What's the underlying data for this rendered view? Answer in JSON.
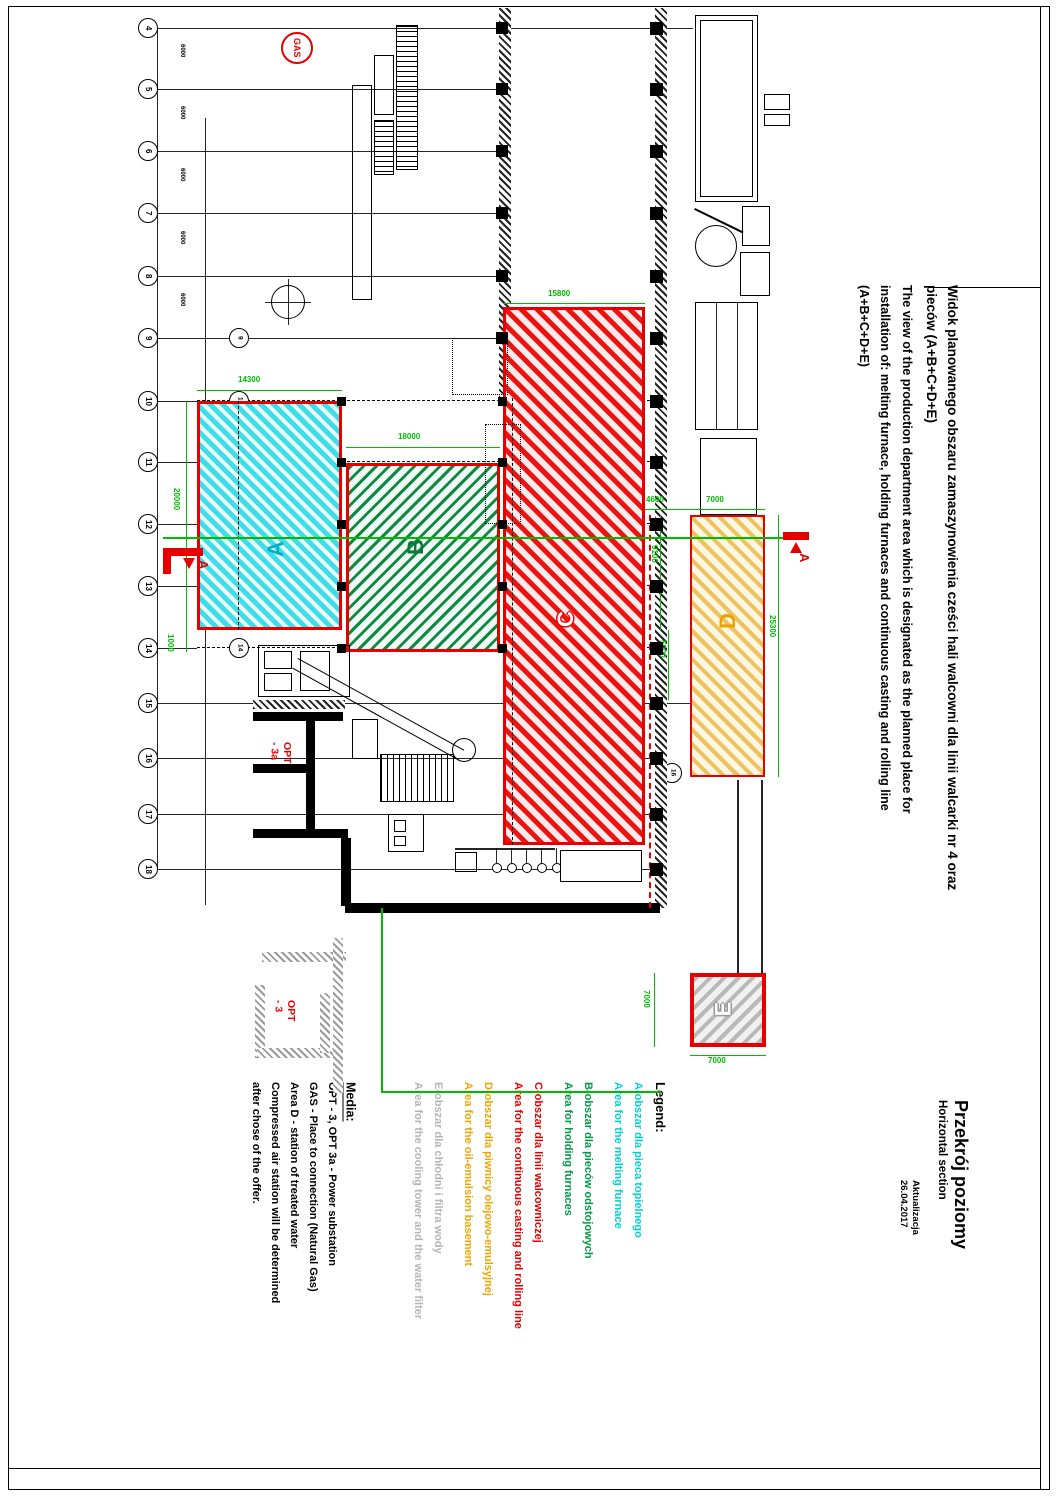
{
  "page": {
    "title_pl_1": "Widok planowanego obszaru zamaszynowienia cześci hali walcowni dla linii walcarki nr 4 oraz",
    "title_pl_2": "pieców  (A+B+C+D+E)",
    "title_en_1": "The view of the production department area which is designated as the planned place for",
    "title_en_2": "installation of: melting furnace, holding furnaces and continuous casting and rolling line",
    "title_en_3": "(A+B+C+D+E)",
    "section_title_pl": "Przekrój poziomy",
    "section_title_en": "Horizontal section",
    "update_label": "Aktualizacja",
    "update_date": "26.04.2017"
  },
  "legend": {
    "heading": "Legend:",
    "items": [
      {
        "id": "A",
        "color": "#00d2d2",
        "line1": "A-obszar dla pieca topielnego",
        "line2": "Area for the melting furnace"
      },
      {
        "id": "B",
        "color": "#009a44",
        "line1": "B-obszar dla pieców odstojowych",
        "line2": "Area for holding furnaces"
      },
      {
        "id": "C",
        "color": "#e60000",
        "line1": "C-obszar dla linii walcowniczej",
        "line2": "Area for the continuous casting and rolling line"
      },
      {
        "id": "D",
        "color": "#f0a500",
        "line1": "D-obszar dla piwnicy olejowo-emulsyjnej",
        "line2": "Area for the oil-emulsion basement"
      },
      {
        "id": "E",
        "color": "#b5b5b5",
        "line1": "E-obszar dla chłodni i filtra wody",
        "line2": "Area for the cooling tower and the water filter"
      }
    ],
    "media_heading": "Media:",
    "media_lines": [
      "OPT - 3, OPT 3a - Power substation",
      "GAS - Place to connection (Natural Gas)",
      "Area D - station of treated water",
      "Compressed air station will be determined",
      "after chose of the offer."
    ]
  },
  "drawing": {
    "area_labels": {
      "a": "A",
      "b": "B",
      "c": "C",
      "d": "D",
      "e": "E"
    },
    "gas_label": "GAS",
    "opt3a_label": "OPT\n- 3a",
    "opt3_label": "OPT\n- 3",
    "section_marker_left": "A",
    "section_marker_right": "A",
    "grid_rows": [
      {
        "n": "4",
        "y": 28
      },
      {
        "n": "5",
        "y": 89
      },
      {
        "n": "6",
        "y": 151
      },
      {
        "n": "7",
        "y": 213
      },
      {
        "n": "8",
        "y": 276
      },
      {
        "n": "9",
        "y": 338
      },
      {
        "n": "10",
        "y": 401
      },
      {
        "n": "11",
        "y": 462
      },
      {
        "n": "12",
        "y": 524
      },
      {
        "n": "13",
        "y": 586
      },
      {
        "n": "14",
        "y": 648
      },
      {
        "n": "15",
        "y": 703
      },
      {
        "n": "16",
        "y": 758
      },
      {
        "n": "17",
        "y": 814
      },
      {
        "n": "18",
        "y": 869
      }
    ],
    "inner_bubbles": [
      {
        "n": "9",
        "x": 239,
        "y": 338
      },
      {
        "n": "10",
        "x": 239,
        "y": 401
      },
      {
        "n": "11",
        "x": 239,
        "y": 462
      },
      {
        "n": "12",
        "x": 239,
        "y": 524
      },
      {
        "n": "13",
        "x": 239,
        "y": 586
      },
      {
        "n": "14",
        "x": 239,
        "y": 648
      },
      {
        "n": "16",
        "x": 672,
        "y": 773
      }
    ],
    "dims": [
      {
        "v": "14300",
        "x": 238,
        "y": 376,
        "o": "h",
        "c": "#00bb00",
        "fs": 8
      },
      {
        "v": "18000",
        "x": 398,
        "y": 433,
        "o": "h",
        "c": "#00bb00",
        "fs": 8
      },
      {
        "v": "15800",
        "x": 548,
        "y": 290,
        "o": "h",
        "c": "#00bb00",
        "fs": 8
      },
      {
        "v": "4600",
        "x": 646,
        "y": 496,
        "o": "h",
        "c": "#00bb00",
        "fs": 8
      },
      {
        "v": "7000",
        "x": 706,
        "y": 496,
        "o": "h",
        "c": "#00bb00",
        "fs": 8
      },
      {
        "v": "7000",
        "x": 708,
        "y": 1057,
        "o": "h",
        "c": "#00bb00",
        "fs": 8
      },
      {
        "v": "20000",
        "x": 172,
        "y": 488,
        "o": "v",
        "c": "#00bb00",
        "fs": 8
      },
      {
        "v": "1000",
        "x": 166,
        "y": 634,
        "o": "v",
        "c": "#00bb00",
        "fs": 8
      },
      {
        "v": "9100",
        "x": 650,
        "y": 545,
        "o": "v",
        "c": "#00bb00",
        "fs": 8
      },
      {
        "v": "5000",
        "x": 658,
        "y": 640,
        "o": "v",
        "c": "#00bb00",
        "fs": 8
      },
      {
        "v": "25300",
        "x": 768,
        "y": 615,
        "o": "v",
        "c": "#00bb00",
        "fs": 8
      },
      {
        "v": "7000",
        "x": 642,
        "y": 990,
        "o": "v",
        "c": "#00bb00",
        "fs": 8
      },
      {
        "v": "6000",
        "x": 179,
        "y": 44,
        "o": "v",
        "c": "#000000",
        "fs": 6
      },
      {
        "v": "6000",
        "x": 179,
        "y": 106,
        "o": "v",
        "c": "#000000",
        "fs": 6
      },
      {
        "v": "6000",
        "x": 179,
        "y": 168,
        "o": "v",
        "c": "#000000",
        "fs": 6
      },
      {
        "v": "6000",
        "x": 179,
        "y": 231,
        "o": "v",
        "c": "#000000",
        "fs": 6
      },
      {
        "v": "6000",
        "x": 179,
        "y": 293,
        "o": "v",
        "c": "#000000",
        "fs": 6
      }
    ]
  }
}
